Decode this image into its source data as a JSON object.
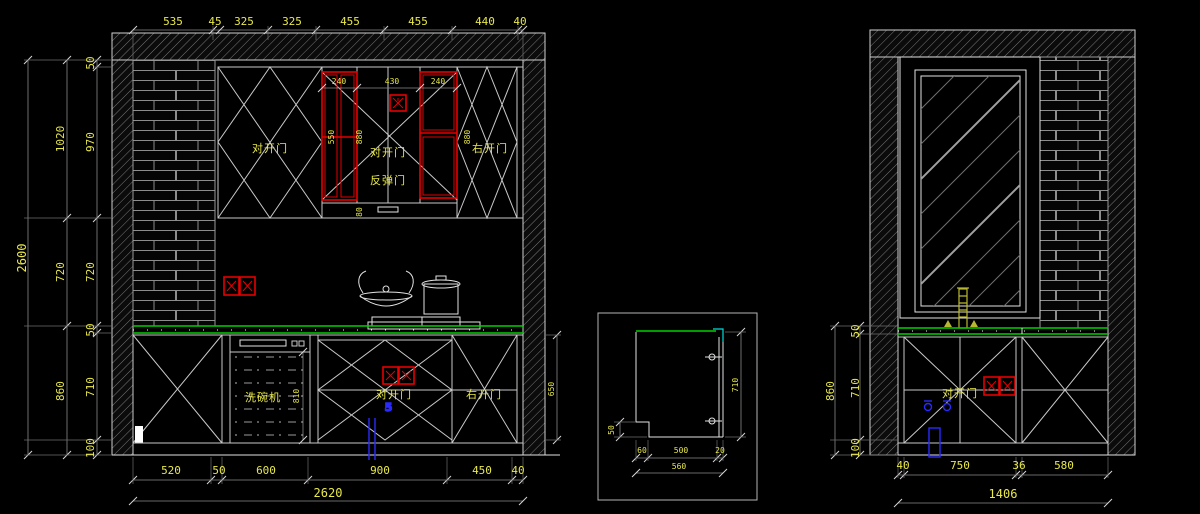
{
  "colors": {
    "background": "#000000",
    "geometry": "#c9c9c9",
    "dimension_text": "#e8e84a",
    "red_accent": "#e60000",
    "counter_green": "#00cf00",
    "plumbing_blue": "#2a2aff",
    "edge_cyan": "#00dddd"
  },
  "left_elevation": {
    "top_dims": [
      "535",
      "45",
      "325",
      "325",
      "455",
      "455",
      "440",
      "40"
    ],
    "v_total": "2600",
    "v_mid": [
      "1020",
      "720",
      "860"
    ],
    "v_inner": [
      "50",
      "970",
      "720",
      "50",
      "710",
      "100"
    ],
    "bottom_dims": [
      "520",
      "50",
      "600",
      "900",
      "450",
      "40"
    ],
    "bottom_total": "2620",
    "wall": {
      "top_dims": [
        "240",
        "430",
        "240"
      ],
      "small_dims": [
        "550",
        "880",
        "880",
        "80"
      ],
      "left_door": "对开门",
      "mid_door": "对开门",
      "mid_door2": "反弹门",
      "right_door": "右开门"
    },
    "base": {
      "dishwasher": "洗碗机",
      "dishwasher_h": "810",
      "mid_door": "对开门",
      "valve_mark": "5",
      "right_door": "右开门",
      "door_h": "650"
    }
  },
  "section_detail": {
    "height": "710",
    "toe_height": "50",
    "bottom_dims": [
      "60",
      "500",
      "20"
    ],
    "bottom_total": "560"
  },
  "right_elevation": {
    "v_total": "860",
    "v_inner": [
      "50",
      "710",
      "100"
    ],
    "bottom_dims": [
      "40",
      "750",
      "36",
      "580"
    ],
    "bottom_total": "1406",
    "base_door": "对开门"
  }
}
